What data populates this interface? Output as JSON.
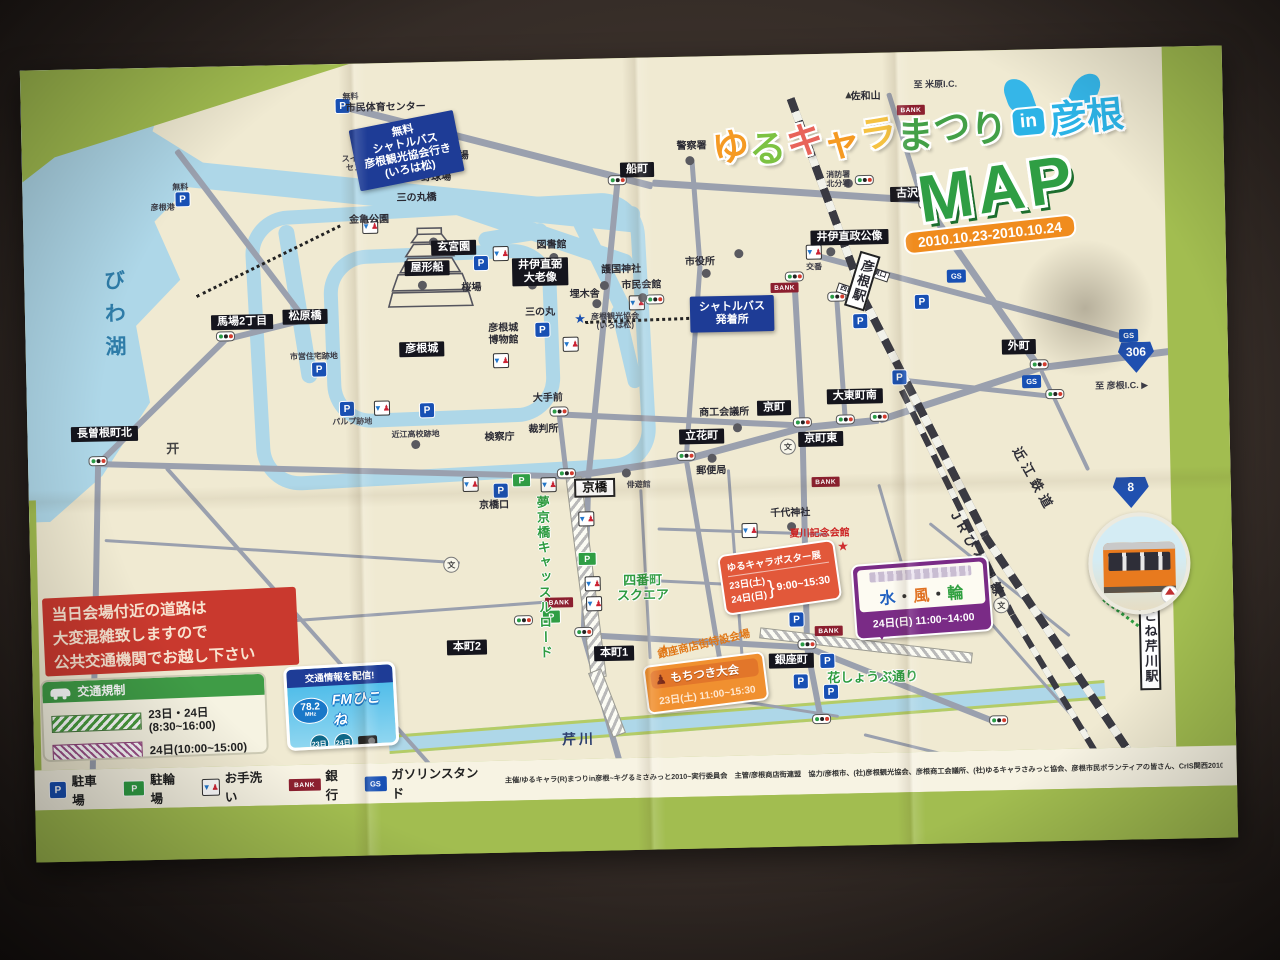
{
  "title": {
    "chars": [
      {
        "ch": "ゆ",
        "color": "#f59a23"
      },
      {
        "ch": "る",
        "color": "#7cc242"
      },
      {
        "ch": "キ",
        "color": "#e8635a"
      },
      {
        "ch": "ャ",
        "color": "#f59a23"
      },
      {
        "ch": "ラ",
        "color": "#f5c242"
      },
      {
        "ch": "ま",
        "color": "#43a047"
      },
      {
        "ch": "つ",
        "color": "#43a047"
      },
      {
        "ch": "り",
        "color": "#43a047"
      }
    ],
    "in_word": "in",
    "place": "彦根",
    "place_color": "#2bb3e6",
    "map_word": "MAP",
    "dates": "2010.10.23-2010.10.24"
  },
  "notice": {
    "line1": "当日会場付近の道路は",
    "line2": "大変混雑致しますので",
    "line3": "公共交通機関でお越し下さい"
  },
  "traffic": {
    "title": "交通規制",
    "rows": [
      {
        "pattern": "green",
        "label": "23日・24日(8:30~16:00)"
      },
      {
        "pattern": "purple",
        "label": "24日(10:00~15:00)"
      }
    ]
  },
  "fm": {
    "header": "交通情報を配信!",
    "freq": "78.2",
    "unit": "MHz",
    "name": "FMひこね",
    "day1": "23日",
    "day2": "24日"
  },
  "legend": [
    {
      "icon": "parking-icon",
      "label": "駐車場"
    },
    {
      "icon": "bicycle-parking-icon",
      "label": "駐輪場"
    },
    {
      "icon": "toilet-icon",
      "label": "お手洗い"
    },
    {
      "icon": "bank-icon",
      "label": "銀行"
    },
    {
      "icon": "gas-station-icon",
      "label": "ガソリンスタンド"
    }
  ],
  "credits": "主催/ゆるキャラ(R)まつりin彦根~キグるミさみっと2010~実行委員会　主管/彦根商店街連盟　協力/彦根市、(社)彦根観光協会、彦根商工会議所、(社)ゆるキャラさみっと協会、彦根市民ボランティアの皆さん、CrIS関西2010",
  "events": {
    "poster": {
      "title": "ゆるキャラポスター展",
      "date1": "23日(土)",
      "date2": "24日(日)",
      "brace": "}",
      "time": "9:00~15:30"
    },
    "suifurin": {
      "chars": "水・風・輪",
      "schedule": "24日(日) 11:00~14:00"
    },
    "mochi": {
      "title": "もちつき大会",
      "schedule": "23日(土) 11:00~15:30",
      "pounder_icon": "♟"
    }
  },
  "routes": {
    "r306": "306",
    "r8": "8",
    "to_hikone_ic": "至 彦根I.C. ▶",
    "to_maibara_ic": "至 米原I.C."
  },
  "map": {
    "labels": [
      {
        "t": "松原橋",
        "x": 280,
        "y": 252,
        "c": "bb"
      },
      {
        "t": "馬場2丁目",
        "x": 217,
        "y": 256,
        "c": "bb"
      },
      {
        "t": "長曽根町北",
        "x": 77,
        "y": 365,
        "c": "bb"
      },
      {
        "t": "船町",
        "x": 615,
        "y": 112,
        "c": "bb"
      },
      {
        "t": "古沢町",
        "x": 890,
        "y": 142,
        "c": "bb"
      },
      {
        "t": "外町",
        "x": 993,
        "y": 297,
        "c": "bb"
      },
      {
        "t": "京町",
        "x": 747,
        "y": 353,
        "c": "bb"
      },
      {
        "t": "京町東",
        "x": 793,
        "y": 385,
        "c": "bb"
      },
      {
        "t": "大東町南",
        "x": 828,
        "y": 343,
        "c": "bb"
      },
      {
        "t": "立花町",
        "x": 674,
        "y": 380,
        "c": "bb"
      },
      {
        "t": "本町2",
        "x": 435,
        "y": 586,
        "c": "bb"
      },
      {
        "t": "本町1",
        "x": 582,
        "y": 595,
        "c": "bb"
      },
      {
        "t": "銀座町",
        "x": 759,
        "y": 606,
        "c": "bb"
      },
      {
        "t": "彦根城",
        "x": 396,
        "y": 287,
        "c": "bb"
      },
      {
        "t": "玄宮園",
        "x": 430,
        "y": 186,
        "c": "bb"
      },
      {
        "t": "屋形船",
        "x": 403,
        "y": 206,
        "c": "bb"
      },
      {
        "t": "井伊直弼\n大老像",
        "x": 516,
        "y": 212,
        "c": "bb"
      },
      {
        "t": "井伊直政公像",
        "x": 826,
        "y": 184,
        "c": "bb"
      },
      {
        "t": "京橋",
        "x": 566,
        "y": 429,
        "c": "wb"
      },
      {
        "t": "市民体育センター",
        "x": 365,
        "y": 45,
        "c": "pl"
      },
      {
        "t": "陸上競技場",
        "x": 422,
        "y": 95,
        "c": "pl"
      },
      {
        "t": "野球場",
        "x": 414,
        "y": 116,
        "c": "pl"
      },
      {
        "t": "三の丸橋",
        "x": 394,
        "y": 136,
        "c": "pl"
      },
      {
        "t": "金亀公園",
        "x": 346,
        "y": 157,
        "c": "pl"
      },
      {
        "t": "桜場",
        "x": 447,
        "y": 227,
        "c": "pl"
      },
      {
        "t": "図書館",
        "x": 528,
        "y": 186,
        "c": "pl"
      },
      {
        "t": "護国神社",
        "x": 597,
        "y": 212,
        "c": "pl"
      },
      {
        "t": "埋木舎",
        "x": 560,
        "y": 236,
        "c": "pl"
      },
      {
        "t": "市民会館",
        "x": 617,
        "y": 228,
        "c": "pl"
      },
      {
        "t": "市役所",
        "x": 676,
        "y": 206,
        "c": "pl"
      },
      {
        "t": "彦根観光協会\n(いろは松)",
        "x": 590,
        "y": 263,
        "c": "pls"
      },
      {
        "t": "三の丸",
        "x": 515,
        "y": 253,
        "c": "pl"
      },
      {
        "t": "彦根城\n博物館",
        "x": 478,
        "y": 274,
        "c": "pl"
      },
      {
        "t": "市営住宅跡地",
        "x": 288,
        "y": 292,
        "c": "pls"
      },
      {
        "t": "パルプ跡地",
        "x": 325,
        "y": 358,
        "c": "pls"
      },
      {
        "t": "近江高校跡地",
        "x": 388,
        "y": 372,
        "c": "pls"
      },
      {
        "t": "検察庁",
        "x": 472,
        "y": 377,
        "c": "pl"
      },
      {
        "t": "裁判所",
        "x": 516,
        "y": 370,
        "c": "pl"
      },
      {
        "t": "大手前",
        "x": 521,
        "y": 339,
        "c": "pl"
      },
      {
        "t": "京橋口",
        "x": 465,
        "y": 445,
        "c": "pl"
      },
      {
        "t": "俳遊館",
        "x": 610,
        "y": 427,
        "c": "pls"
      },
      {
        "t": "商工会議所",
        "x": 697,
        "y": 357,
        "c": "pl"
      },
      {
        "t": "郵便局",
        "x": 683,
        "y": 415,
        "c": "pl"
      },
      {
        "t": "千代神社",
        "x": 761,
        "y": 459,
        "c": "pl"
      },
      {
        "t": "警察署",
        "x": 670,
        "y": 90,
        "c": "pl"
      },
      {
        "t": "消防署\n北分署",
        "x": 816,
        "y": 126,
        "c": "pls"
      },
      {
        "t": "佐和山",
        "x": 845,
        "y": 44,
        "c": "pl"
      },
      {
        "t": "交番",
        "x": 790,
        "y": 213,
        "c": "pls"
      },
      {
        "t": "彦根港",
        "x": 140,
        "y": 140,
        "c": "pls"
      },
      {
        "t": "スイミング\nセンター",
        "x": 340,
        "y": 100,
        "c": "pls"
      },
      {
        "t": "無料",
        "x": 158,
        "y": 120,
        "c": "pls"
      },
      {
        "t": "無料",
        "x": 330,
        "y": 33,
        "c": "pls"
      },
      {
        "t": "無料",
        "x": 367,
        "y": 93,
        "c": "pls"
      },
      {
        "t": "西口",
        "x": 822,
        "y": 237,
        "c": "tinywb",
        "r": 20
      },
      {
        "t": "東口",
        "x": 855,
        "y": 222,
        "c": "tinywb",
        "r": 20
      },
      {
        "t": "夏川記念会館",
        "x": 790,
        "y": 480,
        "c": "red"
      },
      {
        "t": "銀座商店街特設会場",
        "x": 672,
        "y": 588,
        "c": "org",
        "r": -12
      },
      {
        "t": "四番町\nスクエア",
        "x": 612,
        "y": 530,
        "c": "grn"
      },
      {
        "t": "花しょうぶ通り",
        "x": 840,
        "y": 624,
        "c": "grn"
      },
      {
        "t": "夢京橋キャッスルロード",
        "x": 513,
        "y": 518,
        "c": "grnv"
      },
      {
        "t": "びわ湖",
        "x": 88,
        "y": 250,
        "c": "lakev"
      },
      {
        "t": "芹川",
        "x": 545,
        "y": 680,
        "c": "riverlab"
      },
      {
        "t": "近江鉄道",
        "x": 1005,
        "y": 430,
        "c": "railv",
        "r": 62
      },
      {
        "t": "JRびわ湖線",
        "x": 948,
        "y": 505,
        "c": "railv",
        "r": 62
      },
      {
        "t": "彦根駅",
        "x": 838,
        "y": 228,
        "c": "stationv",
        "r": 18
      },
      {
        "t": "ひこね芹川駅",
        "x": 1118,
        "y": 592,
        "c": "stationv",
        "r": 0
      }
    ],
    "navy_boxes": [
      {
        "t": "無料\nシャトルバス\n彦根観光協会行き\n(いろは松)",
        "x": 385,
        "y": 88,
        "r": -10
      },
      {
        "t": "シャトルバス\n発着所",
        "x": 707,
        "y": 258,
        "r": 0
      }
    ],
    "roads": [
      [
        325,
        40,
        317,
        15.6,
        7
      ],
      [
        630,
        122,
        271,
        4.9,
        7
      ],
      [
        900,
        145,
        204,
        56.4,
        7
      ],
      [
        1013,
        315,
        160,
        -6,
        7
      ],
      [
        868,
        38,
        115,
        73.8,
        5
      ],
      [
        155,
        80,
        212,
        54,
        6
      ],
      [
        280,
        252,
        82,
        167.3,
        6
      ],
      [
        200,
        270,
        178,
        136.8,
        6
      ],
      [
        70,
        392,
        308,
        92.2,
        6
      ],
      [
        70,
        392,
        469,
        2.7,
        6
      ],
      [
        538,
        414,
        121,
        -7.1,
        7
      ],
      [
        658,
        399,
        120,
        -14,
        7
      ],
      [
        775,
        370,
        77,
        -4.5,
        7
      ],
      [
        852,
        364,
        168,
        -16.9,
        7
      ],
      [
        532,
        352,
        239,
        3.8,
        6
      ],
      [
        532,
        352,
        63,
        84.5,
        5
      ],
      [
        595,
        122,
        294,
        96.8,
        6
      ],
      [
        560,
        414,
        159,
        92.9,
        6
      ],
      [
        552,
        573,
        131,
        75.4,
        6
      ],
      [
        670,
        100,
        106,
        86.8,
        5
      ],
      [
        676,
        206,
        194,
        95.3,
        5
      ],
      [
        658,
        399,
        208,
        81.7,
        5
      ],
      [
        770,
        222,
        146,
        88,
        6
      ],
      [
        775,
        368,
        222,
        90,
        6
      ],
      [
        775,
        590,
        76,
        80.3,
        6
      ],
      [
        812,
        243,
        123,
        87.2,
        5
      ],
      [
        790,
        198,
        326,
        16,
        6
      ],
      [
        873,
        325,
        156,
        7.4,
        5
      ],
      [
        552,
        573,
        224,
        4.4,
        6
      ],
      [
        775,
        590,
        206,
        22.8,
        6
      ],
      [
        138,
        398,
        397,
        49.6,
        4
      ],
      [
        75,
        470,
        356,
        4.8,
        3
      ],
      [
        150,
        560,
        370,
        -3,
        3
      ],
      [
        1013,
        315,
        115,
        65.9,
        4
      ],
      [
        612,
        430,
        170,
        88,
        3
      ],
      [
        700,
        412,
        190,
        87,
        3
      ],
      [
        628,
        470,
        170,
        3,
        3
      ],
      [
        600,
        520,
        190,
        4,
        3
      ],
      [
        628,
        630,
        180,
        10,
        3
      ],
      [
        850,
        430,
        140,
        75,
        3
      ],
      [
        900,
        470,
        180,
        40,
        3
      ],
      [
        950,
        560,
        160,
        50,
        3
      ],
      [
        830,
        680,
        150,
        15,
        3
      ]
    ],
    "hatched": [
      [
        545,
        410,
        200,
        84,
        14
      ],
      [
        562,
        605,
        67,
        70,
        12
      ],
      [
        728,
        572,
        212,
        8,
        9
      ]
    ],
    "rails": [
      [
        770,
        40,
        215,
        71,
        8
      ],
      [
        838,
        240,
        268,
        64,
        8
      ],
      [
        955,
        481,
        335,
        57.5,
        8
      ],
      [
        875,
        335,
        250,
        65,
        6
      ],
      [
        981,
        562,
        270,
        60,
        6
      ]
    ],
    "dots_lines": [
      [
        172,
        228,
        160,
        -25,
        "#222"
      ],
      [
        368,
        102,
        38,
        8,
        "#222"
      ],
      [
        560,
        262,
        146,
        -1,
        "#222"
      ],
      [
        1072,
        550,
        55,
        38,
        "#2e9c40"
      ]
    ],
    "waters": [
      [
        150,
        92,
        470,
        7,
        26
      ],
      [
        420,
        130,
        200,
        20,
        18
      ],
      [
        262,
        152,
        160,
        82,
        16
      ],
      [
        555,
        150,
        110,
        65,
        16
      ],
      [
        592,
        240,
        85,
        78,
        14
      ],
      [
        455,
        172,
        70,
        -8,
        16
      ]
    ],
    "rings": [
      {
        "x": 225,
        "y": 140,
        "w": 372,
        "h": 252,
        "r": -2
      },
      {
        "x": 300,
        "y": 185,
        "w": 205,
        "h": 150,
        "r": -1
      }
    ],
    "river": {
      "x": 355,
      "y": 672,
      "l": 718,
      "a": -3.2,
      "h": 13
    },
    "signals": [
      [
        200,
        270
      ],
      [
        70,
        392
      ],
      [
        532,
        352
      ],
      [
        538,
        414
      ],
      [
        595,
        122
      ],
      [
        842,
        127
      ],
      [
        905,
        152
      ],
      [
        770,
        222
      ],
      [
        812,
        243
      ],
      [
        775,
        368
      ],
      [
        818,
        366
      ],
      [
        852,
        364
      ],
      [
        1013,
        315
      ],
      [
        552,
        573
      ],
      [
        492,
        560
      ],
      [
        775,
        590
      ],
      [
        788,
        665
      ],
      [
        965,
        670
      ],
      [
        630,
        242
      ],
      [
        1028,
        345
      ],
      [
        658,
        399
      ]
    ],
    "parkings": [
      [
        322,
        42
      ],
      [
        160,
        132
      ],
      [
        367,
        103
      ],
      [
        457,
        202
      ],
      [
        517,
        270
      ],
      [
        293,
        305
      ],
      [
        320,
        345
      ],
      [
        400,
        348
      ],
      [
        472,
        430
      ],
      [
        835,
        268
      ],
      [
        897,
        250
      ],
      [
        873,
        325
      ],
      [
        765,
        565
      ],
      [
        795,
        607
      ],
      [
        768,
        627
      ],
      [
        798,
        638
      ]
    ],
    "bike_parkings": [
      [
        493,
        420
      ],
      [
        557,
        500
      ],
      [
        520,
        557
      ]
    ],
    "toilets": [
      [
        397,
        100
      ],
      [
        347,
        163
      ],
      [
        477,
        193
      ],
      [
        545,
        285
      ],
      [
        475,
        300
      ],
      [
        355,
        345
      ],
      [
        442,
        423
      ],
      [
        520,
        425
      ],
      [
        557,
        460
      ],
      [
        562,
        525
      ],
      [
        563,
        545
      ],
      [
        720,
        475
      ],
      [
        612,
        245
      ],
      [
        790,
        198
      ]
    ],
    "banks": [
      [
        760,
        233
      ],
      [
        797,
        428
      ],
      [
        528,
        543
      ],
      [
        797,
        577
      ],
      [
        890,
        58
      ]
    ],
    "gas_stations": [
      [
        932,
        225
      ],
      [
        1103,
        288
      ],
      [
        1005,
        332
      ]
    ],
    "schools": [
      [
        760,
        392
      ],
      [
        421,
        503
      ],
      [
        970,
        555
      ]
    ],
    "stars": [
      {
        "x": 555,
        "y": 260,
        "color": "#1a50b0"
      },
      {
        "x": 813,
        "y": 493,
        "color": "#d03030"
      },
      {
        "x": 632,
        "y": 592,
        "color": "#e07818"
      }
    ],
    "poi_dots": [
      [
        410,
        180
      ],
      [
        398,
        223
      ],
      [
        530,
        198
      ],
      [
        580,
        227
      ],
      [
        572,
        245
      ],
      [
        618,
        240
      ],
      [
        682,
        217
      ],
      [
        715,
        198
      ],
      [
        508,
        225
      ],
      [
        684,
        402
      ],
      [
        710,
        372
      ],
      [
        762,
        472
      ],
      [
        668,
        104
      ],
      [
        826,
        130
      ],
      [
        807,
        198
      ],
      [
        388,
        382
      ],
      [
        598,
        415
      ]
    ],
    "mountain": {
      "x": 828,
      "y": 42,
      "glyph": "▲"
    },
    "torii": {
      "x": 145,
      "y": 380,
      "glyph": "开"
    },
    "icon_glyphs": {
      "parking": "P",
      "bike": "P",
      "toilet_blue": "▼",
      "toilet_red": "♟",
      "bank": "BANK",
      "gas": "GS",
      "school": "文"
    }
  }
}
